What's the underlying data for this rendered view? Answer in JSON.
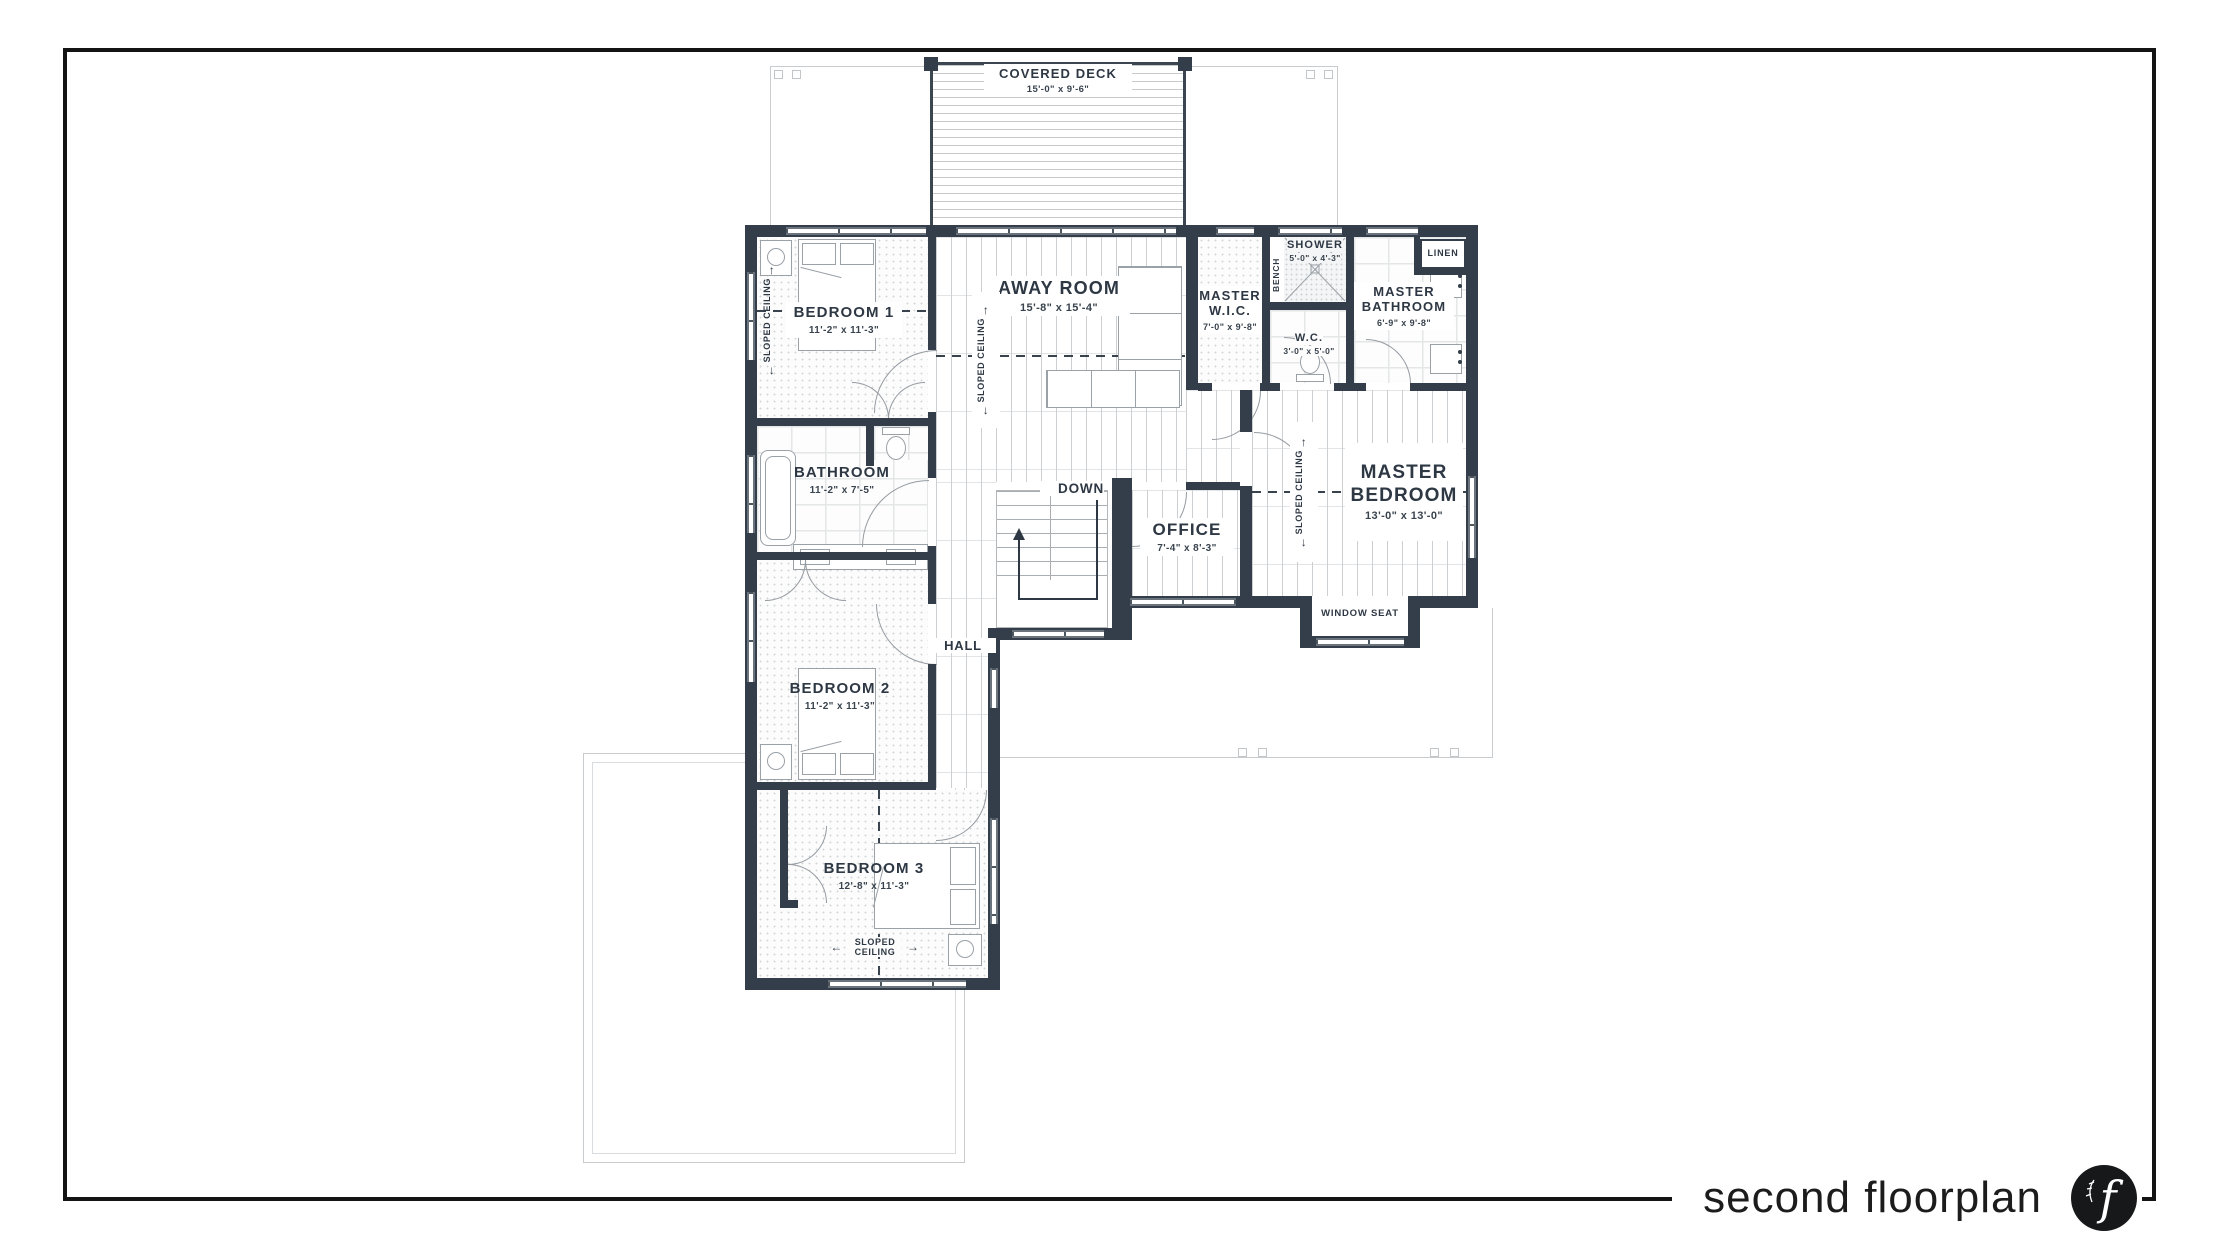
{
  "footer": {
    "title": "second floorplan",
    "logo_letter": "f"
  },
  "rooms": {
    "covered_deck": {
      "name": "COVERED DECK",
      "dims": "15'-0\" x 9'-6\""
    },
    "bedroom1": {
      "name": "BEDROOM 1",
      "dims": "11'-2\" x 11'-3\""
    },
    "away_room": {
      "name": "AWAY ROOM",
      "dims": "15'-8\" x 15'-4\""
    },
    "master_wic": {
      "name": "MASTER W.I.C.",
      "dims": "7'-0\" x 9'-8\""
    },
    "shower": {
      "name": "SHOWER",
      "dims": "5'-0\" x 4'-3\""
    },
    "master_bathroom": {
      "name": "MASTER BATHROOM",
      "dims": "6'-9\" x 9'-8\""
    },
    "wc": {
      "name": "W.C.",
      "dims": "3'-0\" x 5'-0\""
    },
    "master_bedroom": {
      "name": "MASTER BEDROOM",
      "dims": "13'-0\" x 13'-0\""
    },
    "bathroom": {
      "name": "BATHROOM",
      "dims": "11'-2\" x 7'-5\""
    },
    "office": {
      "name": "OFFICE",
      "dims": "7'-4\" x 8'-3\""
    },
    "bedroom2": {
      "name": "BEDROOM 2",
      "dims": "11'-2\" x 11'-3\""
    },
    "bedroom3": {
      "name": "BEDROOM 3",
      "dims": "12'-8\" x 11'-3\""
    }
  },
  "annotations": {
    "down": "DOWN",
    "hall": "HALL",
    "linen": "LINEN",
    "bench": "BENCH",
    "window_seat": "WINDOW SEAT",
    "sloped_ceiling": "SLOPED CEILING",
    "arrow_up": "↑",
    "arrow_down": "↓",
    "arrow_left": "←",
    "arrow_right": "→"
  },
  "colors": {
    "wall": "#333e4a",
    "text": "#2e3844",
    "outline": "#c9ccce",
    "logo_bg": "#17181a"
  }
}
